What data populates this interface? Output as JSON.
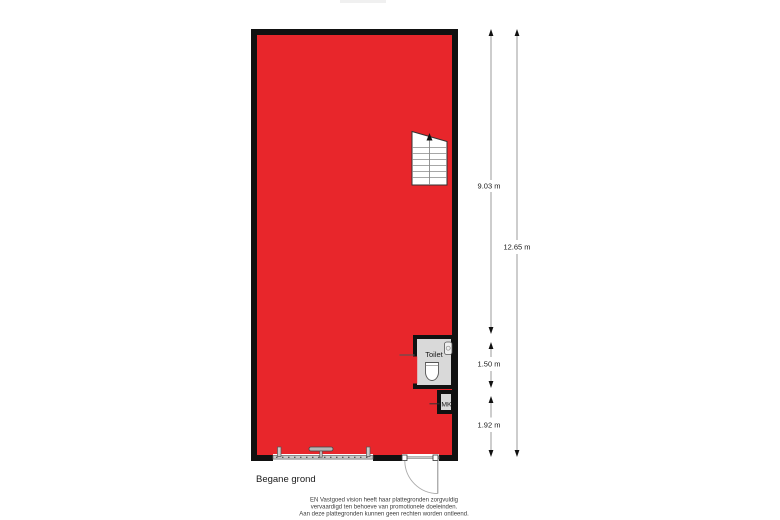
{
  "floorplan": {
    "floor_label": "Begane grond",
    "toilet_label": "Toilet",
    "mk_label": "MK",
    "dimensions": {
      "main_height": "9.03 m",
      "total_height": "12.65 m",
      "toilet_height": "1.50 m",
      "entry_height": "1.92 m"
    },
    "colors": {
      "room_fill": "#e8262b",
      "wall": "#111111",
      "wet_room_fill": "#d9d9d9",
      "fixture_fill": "#ffffff",
      "frame_gray": "#c9c9c9",
      "dimension_line": "#9b9b9b",
      "label_text": "#1a1a1a",
      "disclaimer_text": "#3c3c3c"
    }
  },
  "disclaimer": {
    "line1": "EN Vastgoed vision heeft haar plattegronden zorgvuldig",
    "line2": "vervaardigd ten behoeve van promotionele doeleinden.",
    "line3": "Aan deze plattegronden kunnen geen rechten worden ontleend."
  }
}
